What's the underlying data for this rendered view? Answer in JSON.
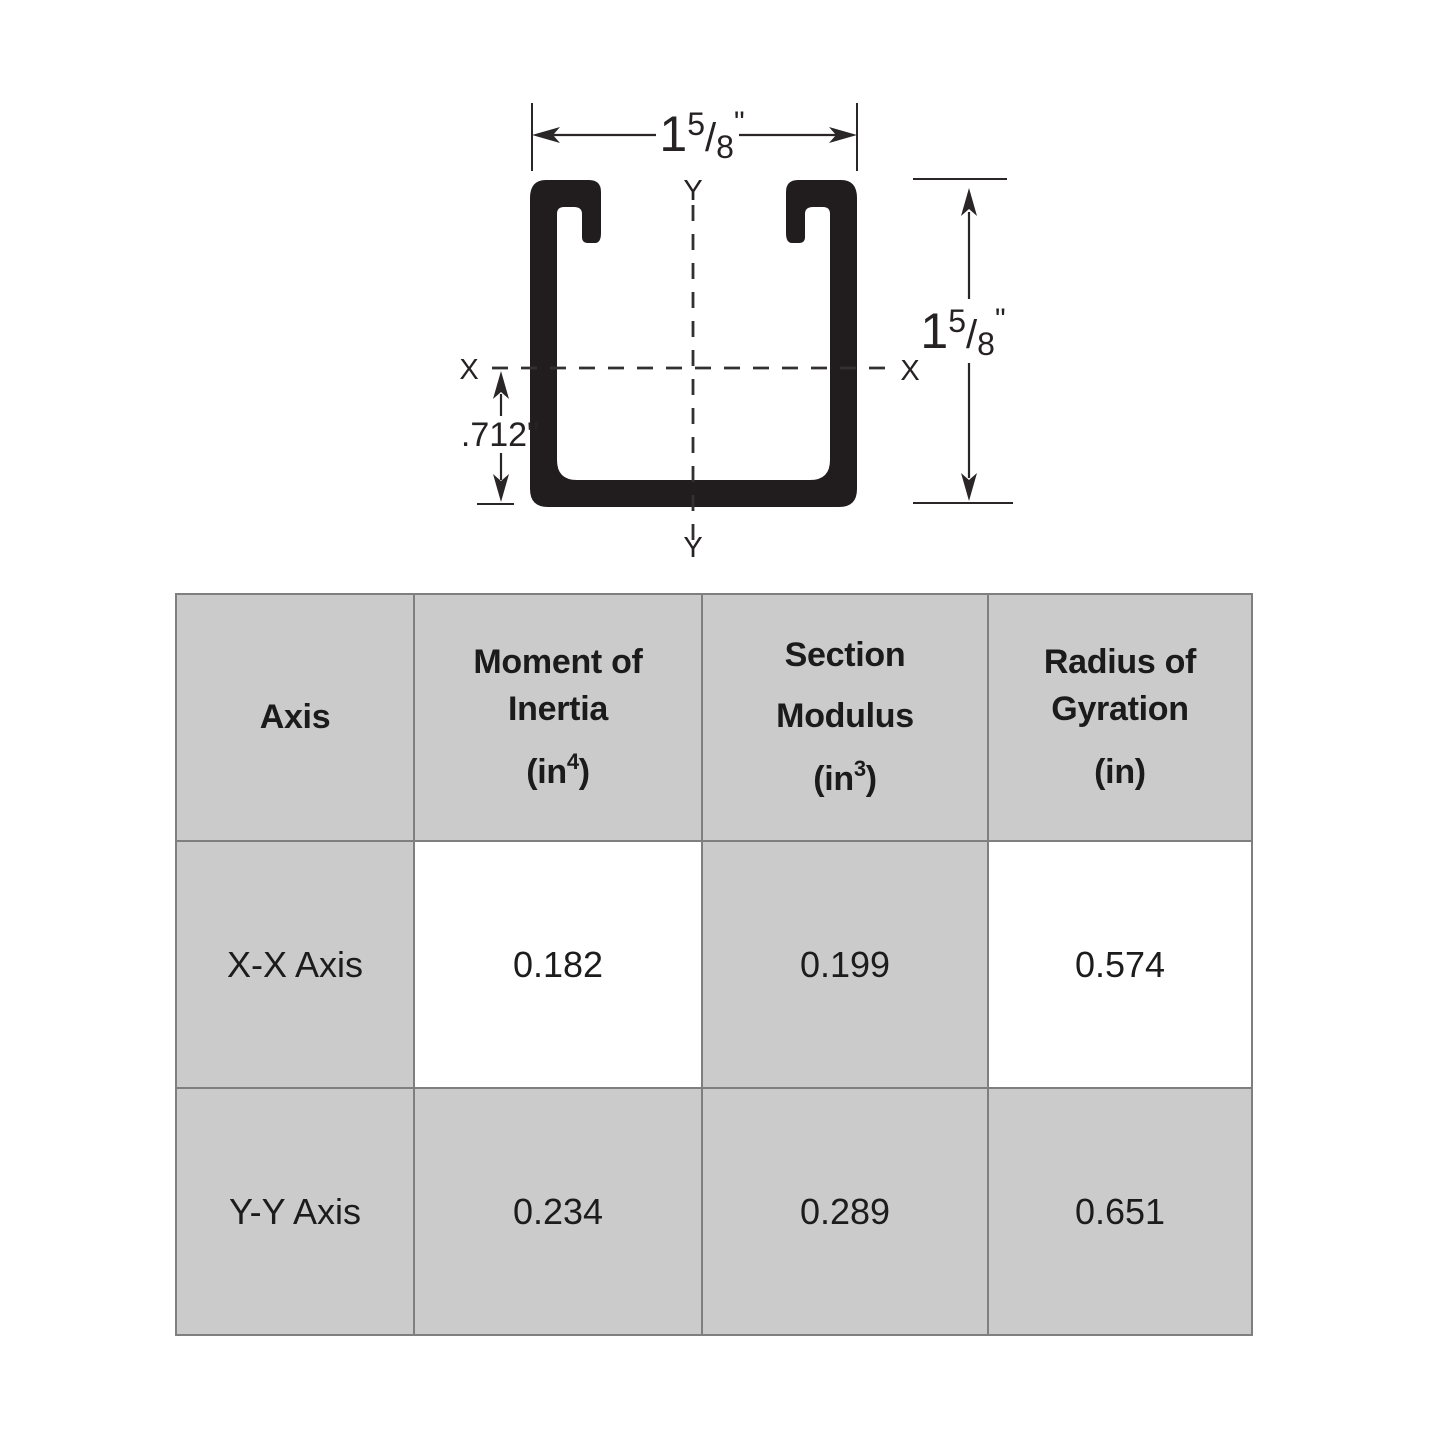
{
  "diagram": {
    "width_dim": {
      "whole": "1",
      "numerator": "5",
      "slash": "/",
      "denominator": "8",
      "inches_mark": "\""
    },
    "height_dim": {
      "whole": "1",
      "numerator": "5",
      "slash": "/",
      "denominator": "8",
      "inches_mark": "\""
    },
    "offset_dim_label": ".712\"",
    "axis_x_left_label": "X",
    "axis_x_right_label": "X",
    "axis_y_top_label": "Y",
    "axis_y_bottom_label": "Y",
    "ink_color": "#2a2627",
    "channel_fill_color": "#211d1e"
  },
  "table": {
    "grid_line_color": "#7f7f7f",
    "shaded_cell_color": "#cbcbcb",
    "headers": [
      {
        "lines": [
          "Axis"
        ]
      },
      {
        "lines": [
          "Moment of",
          "Inertia"
        ],
        "unit_pre": "(in",
        "unit_sup": "4",
        "unit_post": ")"
      },
      {
        "lines": [
          "Section",
          "Modulus"
        ],
        "unit_pre": "(in",
        "unit_sup": "3",
        "unit_post": ")"
      },
      {
        "lines": [
          "Radius of",
          "Gyration"
        ],
        "unit_pre": "(in",
        "unit_sup": "",
        "unit_post": ")"
      }
    ],
    "rows": [
      {
        "axis_label": "X-X Axis",
        "moment_of_inertia": "0.182",
        "section_modulus": "0.199",
        "radius_of_gyration": "0.574"
      },
      {
        "axis_label": "Y-Y Axis",
        "moment_of_inertia": "0.234",
        "section_modulus": "0.289",
        "radius_of_gyration": "0.651"
      }
    ]
  },
  "chart_data": {
    "type": "table",
    "columns": [
      "Axis",
      "Moment of Inertia (in^4)",
      "Section Modulus (in^3)",
      "Radius of Gyration (in)"
    ],
    "rows": [
      [
        "X-X Axis",
        "0.182",
        "0.199",
        "0.574"
      ],
      [
        "Y-Y Axis",
        "0.234",
        "0.289",
        "0.651"
      ]
    ],
    "drawing_dimensions": {
      "width": "1 5/8 in",
      "height": "1 5/8 in",
      "x_axis_offset_from_base": "0.712 in"
    }
  }
}
